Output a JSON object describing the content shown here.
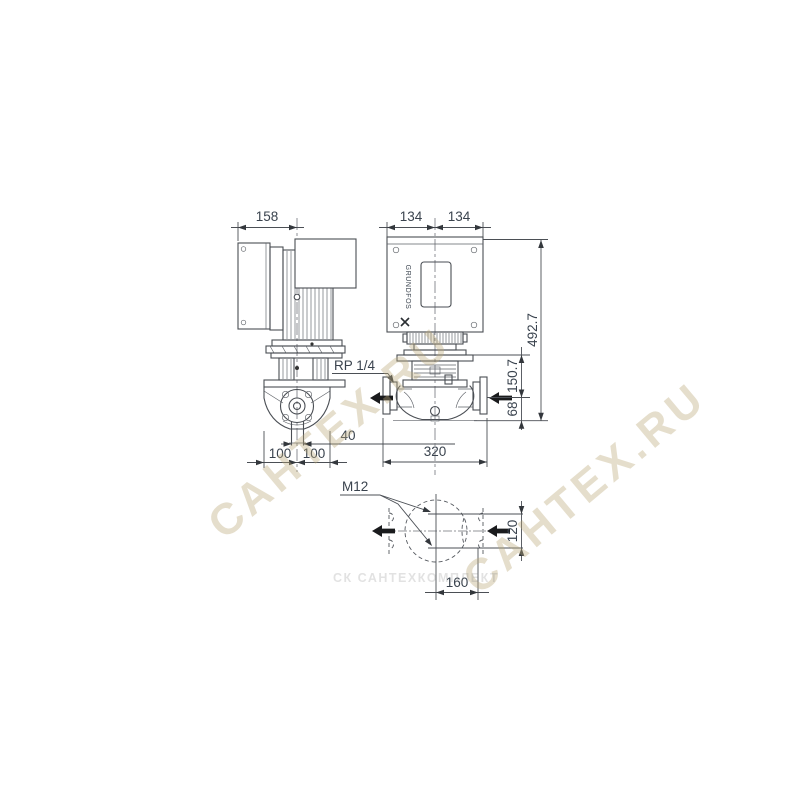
{
  "side_view": {
    "dim_width": "158",
    "label_gauge_port": "RP 1/4",
    "dim_drain_width": "40",
    "dim_port_left": "100",
    "dim_port_right": "100"
  },
  "front_view": {
    "dim_half_left": "134",
    "dim_half_right": "134",
    "dim_total_height": "492.7",
    "dim_top_plate_to_port_axis": "150.7",
    "dim_port_axis_to_base": "68",
    "dim_port_to_port": "320",
    "brand": "GRUNDFOS"
  },
  "bottom_view": {
    "label_bolt_size": "M12",
    "dim_hole_spacing_vertical": "120",
    "dim_hole_spacing_horizontal": "160"
  },
  "watermarks": {
    "diagonal": "САНТЕХ.RU",
    "diagonal2": "САНТЕХ.RU",
    "footer": "СК САНТЕХКОМПЛЕКТ"
  }
}
